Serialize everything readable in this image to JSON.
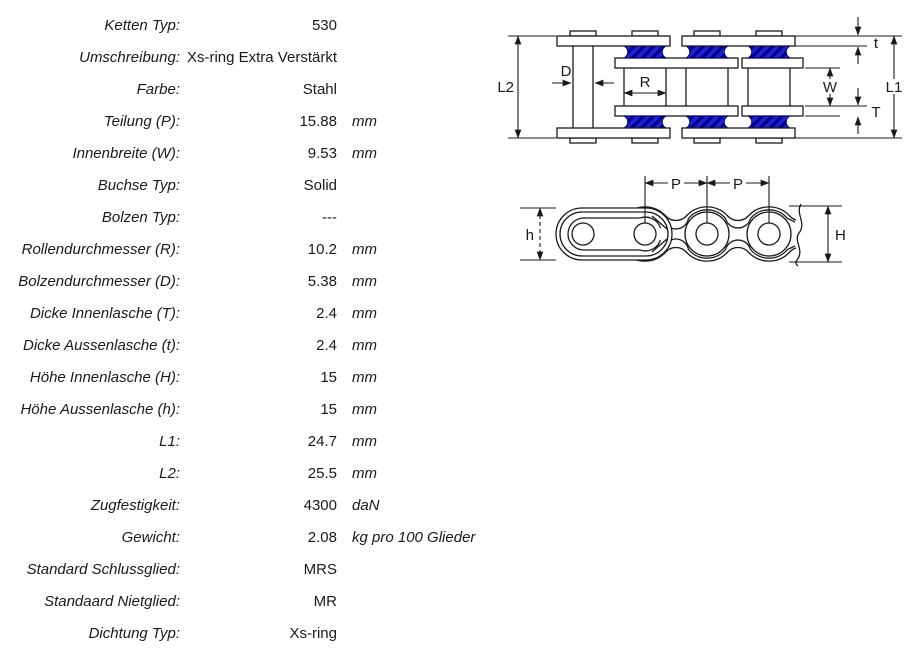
{
  "spec_table": {
    "rows": [
      {
        "label": "Ketten Typ:",
        "value": "530",
        "unit": ""
      },
      {
        "label": "Umschreibung:",
        "value": "Xs-ring Extra Verstärkt",
        "unit": ""
      },
      {
        "label": "Farbe:",
        "value": "Stahl",
        "unit": ""
      },
      {
        "label": "Teilung (P):",
        "value": "15.88",
        "unit": "mm"
      },
      {
        "label": "Innenbreite (W):",
        "value": "9.53",
        "unit": "mm"
      },
      {
        "label": "Buchse Typ:",
        "value": "Solid",
        "unit": ""
      },
      {
        "label": "Bolzen Typ:",
        "value": "---",
        "unit": ""
      },
      {
        "label": "Rollendurchmesser (R):",
        "value": "10.2",
        "unit": "mm"
      },
      {
        "label": "Bolzendurchmesser (D):",
        "value": "5.38",
        "unit": "mm"
      },
      {
        "label": "Dicke Innenlasche (T):",
        "value": "2.4",
        "unit": "mm"
      },
      {
        "label": "Dicke Aussenlasche (t):",
        "value": "2.4",
        "unit": "mm"
      },
      {
        "label": "Höhe Innenlasche (H):",
        "value": "15",
        "unit": "mm"
      },
      {
        "label": "Höhe Aussenlasche (h):",
        "value": "15",
        "unit": "mm"
      },
      {
        "label": "L1:",
        "value": "24.7",
        "unit": "mm"
      },
      {
        "label": "L2:",
        "value": "25.5",
        "unit": "mm"
      },
      {
        "label": "Zugfestigkeit:",
        "value": "4300",
        "unit": "daN"
      },
      {
        "label": "Gewicht:",
        "value": "2.08",
        "unit": "kg pro 100 Glieder"
      },
      {
        "label": "Standard Schlussglied:",
        "value": "MRS",
        "unit": ""
      },
      {
        "label": "Standaard Nietglied:",
        "value": "MR",
        "unit": ""
      },
      {
        "label": "Dichtung Typ:",
        "value": "Xs-ring",
        "unit": ""
      }
    ]
  },
  "diagram": {
    "top_view": {
      "l2": "L2",
      "d": "D",
      "r": "R",
      "w": "W",
      "t_outer": "t",
      "t_inner": "T",
      "l1": "L1"
    },
    "side_view": {
      "p_left": "P",
      "p_right": "P",
      "h_outer": "h",
      "h_inner": "H"
    },
    "colors": {
      "line": "#1a1a1a",
      "seal_blue": "#2121cf",
      "seal_blue_dark": "#00008c"
    }
  }
}
